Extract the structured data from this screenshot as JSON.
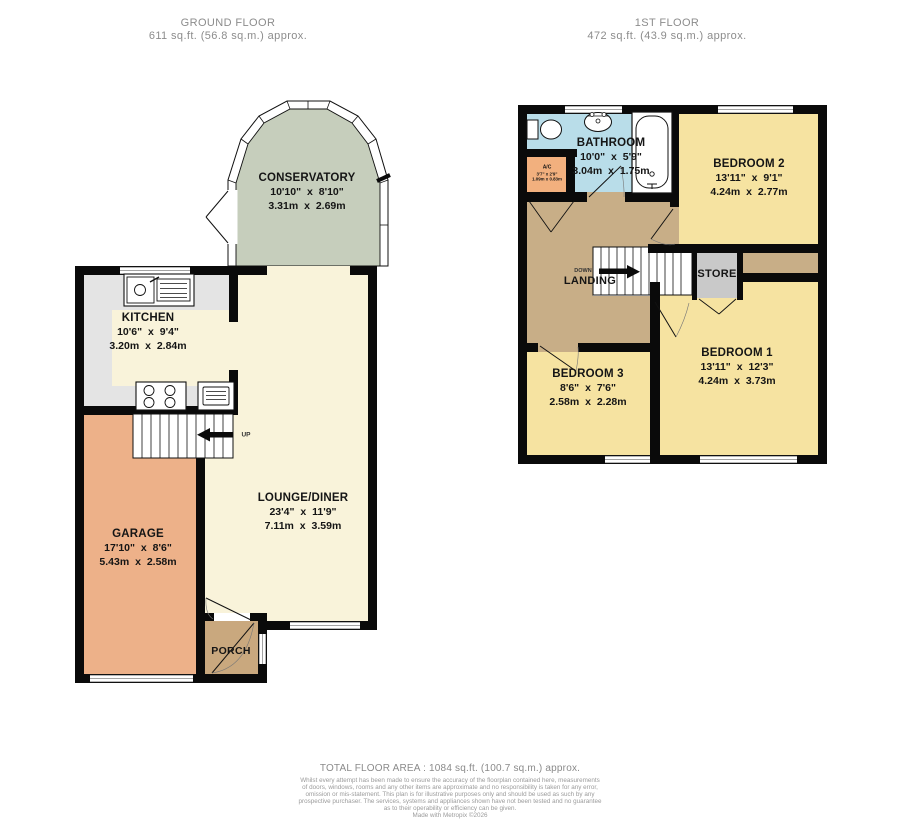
{
  "headers": {
    "ground": {
      "title": "GROUND FLOOR",
      "area": "611 sq.ft. (56.8 sq.m.) approx."
    },
    "first": {
      "title": "1ST FLOOR",
      "area": "472 sq.ft. (43.9 sq.m.) approx."
    }
  },
  "ground_floor": {
    "conservatory": {
      "name": "CONSERVATORY",
      "imperial": "10'10\" x 8'10\"",
      "metric": "3.31m x 2.69m"
    },
    "kitchen": {
      "name": "KITCHEN",
      "imperial": "10'6\" x 9'4\"",
      "metric": "3.20m x 2.84m"
    },
    "lounge_diner": {
      "name": "LOUNGE/DINER",
      "imperial": "23'4\" x 11'9\"",
      "metric": "7.11m x 3.59m"
    },
    "garage": {
      "name": "GARAGE",
      "imperial": "17'10\" x 8'6\"",
      "metric": "5.43m x 2.58m"
    },
    "porch": {
      "name": "PORCH"
    },
    "stairs_label": "UP"
  },
  "first_floor": {
    "bathroom": {
      "name": "BATHROOM",
      "imperial": "10'0\" x 5'9\"",
      "metric": "3.04m x 1.75m"
    },
    "airing_cupboard": {
      "name": "A/C",
      "imperial": "3'7\" x 2'9\"",
      "metric": "1.09m x 0.83m"
    },
    "bedroom1": {
      "name": "BEDROOM 1",
      "imperial": "13'11\" x 12'3\"",
      "metric": "4.24m x 3.73m"
    },
    "bedroom2": {
      "name": "BEDROOM 2",
      "imperial": "13'11\" x 9'1\"",
      "metric": "4.24m x 2.77m"
    },
    "bedroom3": {
      "name": "BEDROOM 3",
      "imperial": "8'6\" x 7'6\"",
      "metric": "2.58m x 2.28m"
    },
    "landing": {
      "name": "LANDING"
    },
    "store": {
      "name": "STORE"
    },
    "stairs_label": "DOWN"
  },
  "footer": {
    "total_area": "TOTAL FLOOR AREA : 1084 sq.ft. (100.7 sq.m.) approx.",
    "disclaimer_lines": [
      "Whilst every attempt has been made to ensure the accuracy of the floorplan contained here, measurements",
      "of doors, windows, rooms and any other items are approximate and no responsibility is taken for any error,",
      "omission or mis-statement. This plan is for illustrative purposes only and should be used as such by any",
      "prospective purchaser. The services, systems and appliances shown have not been tested and no guarantee",
      "as to their operability or efficiency can be given.",
      "Made with Metropix ©2026"
    ]
  },
  "colors": {
    "wall": "#0a0a0a",
    "cream": "#f9f3da",
    "bedroom_yellow": "#f6e3a1",
    "conservatory_green": "#c6cebc",
    "garage_orange": "#edb189",
    "porch_tan": "#c9a87e",
    "landing_tan": "#c8ae87",
    "bathroom_blue": "#b9dde9",
    "ac_orange": "#f2b07e",
    "store_grey": "#c9c9c9",
    "kitchen_grey": "#e4e4e4",
    "window_line": "#999999"
  }
}
